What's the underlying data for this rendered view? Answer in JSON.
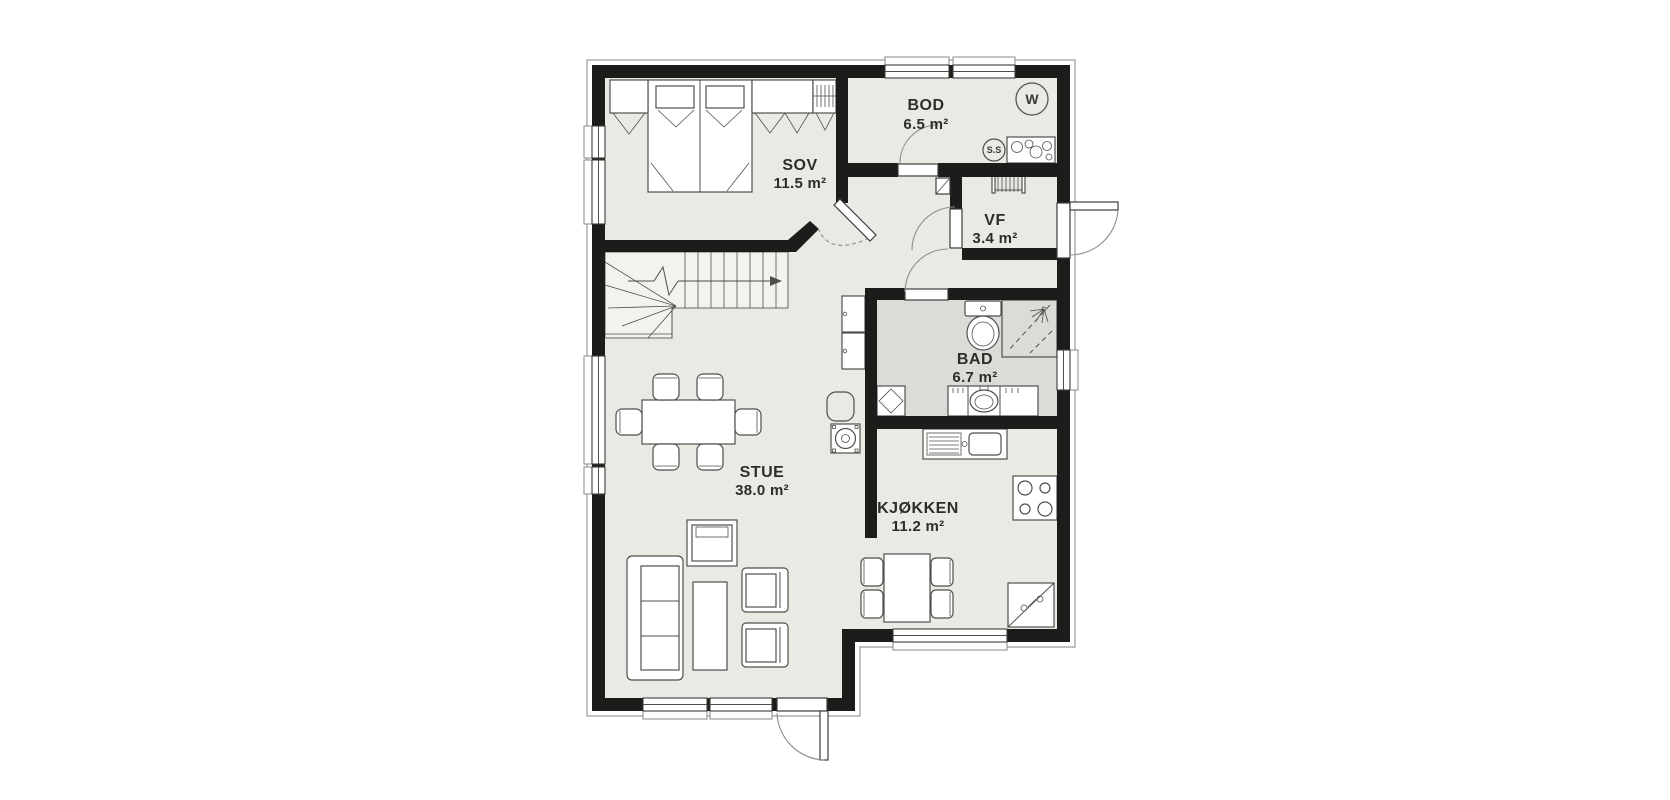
{
  "rooms": [
    {
      "id": "sov",
      "name": "SOV",
      "area": "11.5 m²"
    },
    {
      "id": "bod",
      "name": "BOD",
      "area": "6.5 m²"
    },
    {
      "id": "vf",
      "name": "VF",
      "area": "3.4 m²"
    },
    {
      "id": "bad",
      "name": "BAD",
      "area": "6.7 m²"
    },
    {
      "id": "stue",
      "name": "STUE",
      "area": "38.0 m²"
    },
    {
      "id": "kjokken",
      "name": "KJØKKEN",
      "area": "11.2 m²"
    }
  ],
  "symbols": {
    "washing_machine": "W",
    "water_heater": "S.S"
  },
  "colors": {
    "wall": "#1c1c1a",
    "floor": "#eae9e3",
    "bathroom_floor": "#dbdbd7",
    "background": "#ffffff",
    "furniture_stroke": "#4f4f4c",
    "outline": "#9a9a96"
  }
}
